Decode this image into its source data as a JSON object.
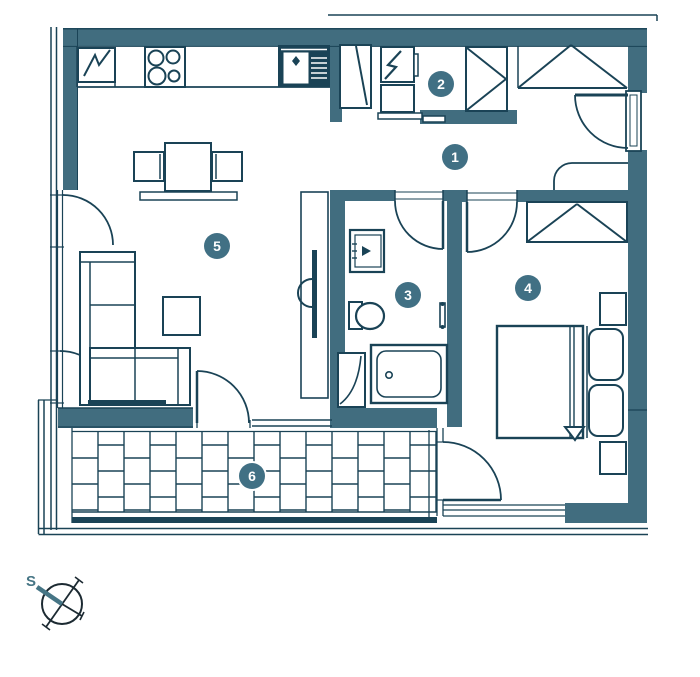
{
  "palette": {
    "background": "#ffffff",
    "wall": "#416d7f",
    "line": "#1a4356",
    "line_dark": "#14323f",
    "marker": "#417084",
    "marker_text": "#ffffff",
    "accent": "#467585"
  },
  "markers": [
    {
      "label": "1",
      "x": 455,
      "y": 157
    },
    {
      "label": "2",
      "x": 441,
      "y": 84
    },
    {
      "label": "3",
      "x": 408,
      "y": 295
    },
    {
      "label": "4",
      "x": 528,
      "y": 288
    },
    {
      "label": "5",
      "x": 217,
      "y": 246
    },
    {
      "label": "6",
      "x": 252,
      "y": 476
    }
  ],
  "compass": {
    "label": "S"
  }
}
